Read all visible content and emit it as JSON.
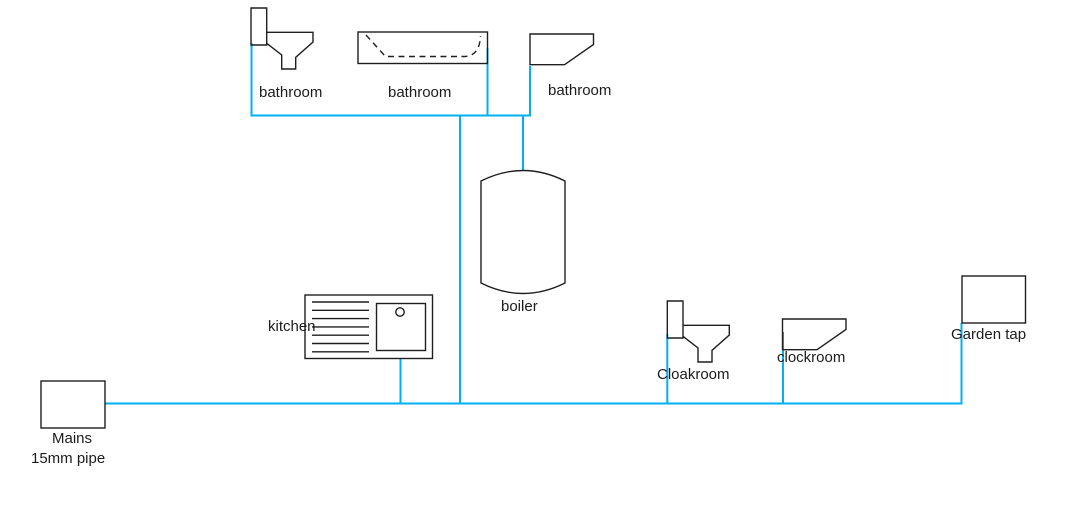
{
  "diagram_type": "plumbing-supply-diagram",
  "colors": {
    "pipe": "#00B0F0",
    "outline": "#1f1f1f",
    "text": "#1c1c1c",
    "background": "#ffffff"
  },
  "labels": {
    "bathroom_toilet": "bathroom",
    "bathroom_bathtub": "bathroom",
    "bathroom_sink": "bathroom",
    "boiler": "boiler",
    "kitchen": "kitchen",
    "cloakroom": "Cloakroom",
    "clockroom": "clockroom",
    "garden_tap": "Garden tap",
    "mains_name": "Mains",
    "mains_pipe_size": "15mm pipe"
  },
  "fixtures": [
    {
      "type": "toilet",
      "room": "bathroom"
    },
    {
      "type": "bathtub",
      "room": "bathroom"
    },
    {
      "type": "sink",
      "room": "bathroom"
    },
    {
      "type": "boiler-cylinder",
      "room": "boiler"
    },
    {
      "type": "kitchen-sink-with-drainer",
      "room": "kitchen"
    },
    {
      "type": "toilet",
      "room": "Cloakroom"
    },
    {
      "type": "sink",
      "room": "clockroom"
    },
    {
      "type": "tap-box",
      "room": "Garden tap"
    },
    {
      "type": "supply-box",
      "room": "Mains 15mm pipe"
    }
  ],
  "pipes": [
    "mains to garden tap main run",
    "bathroom manifold",
    "bathroom toilet drop",
    "bathtub drop",
    "bathroom sink drop",
    "bathroom main drop",
    "boiler feed",
    "kitchen drop",
    "cloakroom toilet drop",
    "clockroom sink drop",
    "garden tap riser"
  ]
}
